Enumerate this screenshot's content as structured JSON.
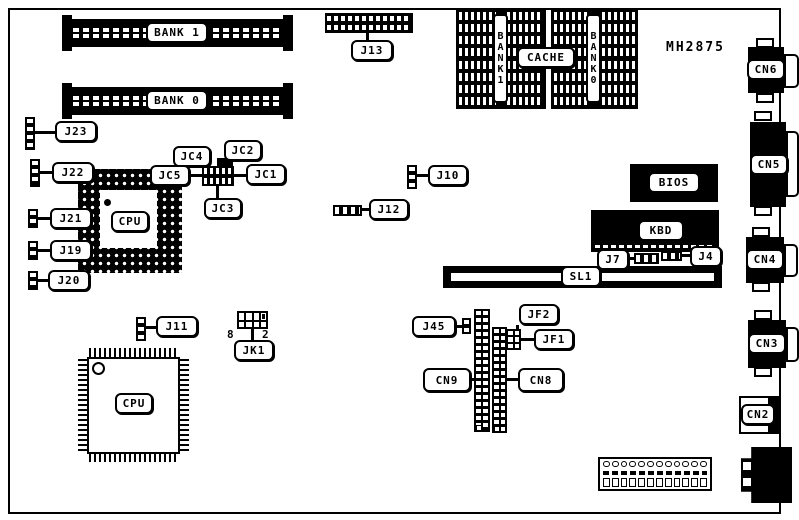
{
  "title": "MH2875",
  "memory": {
    "simm_bank1": "BANK 1",
    "simm_bank0": "BANK 0",
    "array_bank1": "BANK1",
    "array_bank0": "BANK0",
    "cache": "CACHE"
  },
  "chips": {
    "cpu_pga": "CPU",
    "cpu_qfp": "CPU",
    "bios": "BIOS",
    "kbd": "KBD"
  },
  "slots": {
    "sl1": "SL1"
  },
  "jumpers": {
    "j13": "J13",
    "j23": "J23",
    "j22": "J22",
    "j21": "J21",
    "j19": "J19",
    "j20": "J20",
    "jc1": "JC1",
    "jc2": "JC2",
    "jc3": "JC3",
    "jc4": "JC4",
    "jc5": "JC5",
    "j10": "J10",
    "j12": "J12",
    "j7": "J7",
    "j4": "J4",
    "j11": "J11",
    "jk1": "JK1",
    "jk1_pin_left": "8",
    "jk1_pin_right": "2",
    "j45": "J45",
    "jf1": "JF1",
    "jf2": "JF2"
  },
  "connectors": {
    "cn2": "CN2",
    "cn3": "CN3",
    "cn4": "CN4",
    "cn5": "CN5",
    "cn6": "CN6",
    "cn8": "CN8",
    "cn9": "CN9"
  },
  "colors": {
    "ink": "#000000",
    "paper": "#ffffff"
  }
}
